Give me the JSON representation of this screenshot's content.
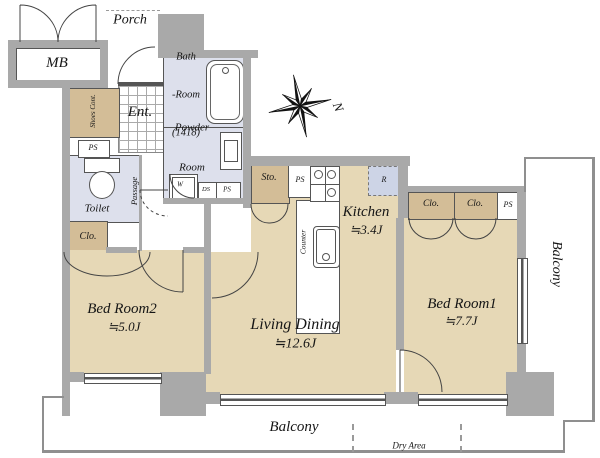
{
  "colors": {
    "floor": "#e6d8b6",
    "closet": "#d3bd97",
    "wet_room": "#dde0ec",
    "wall": "#a9a9a9",
    "fridge_box": "#cdd4e6"
  },
  "labels": {
    "mb": "MB",
    "porch": "Porch",
    "ent": "Ent.",
    "shoes": "Shoes Cont.",
    "bath_line1": "Bath",
    "bath_line2": "-Room",
    "bath_line3": "(1418)",
    "powder_line1": "Powder",
    "powder_line2": "Room",
    "toilet": "Toilet",
    "passage": "Passage",
    "clo": "Clo.",
    "sto": "Sto.",
    "ps": "PS",
    "ds": "DS",
    "w": "W",
    "r": "R",
    "counter": "Counter",
    "kitchen": "Kitchen",
    "kitchen_size": "≒3.4J",
    "living": "Living Dining",
    "living_size": "≒12.6J",
    "bed1": "Bed Room1",
    "bed1_size": "≒7.7J",
    "bed2": "Bed Room2",
    "bed2_size": "≒5.0J",
    "balcony": "Balcony",
    "dry_area": "Dry Area",
    "north": "N"
  }
}
